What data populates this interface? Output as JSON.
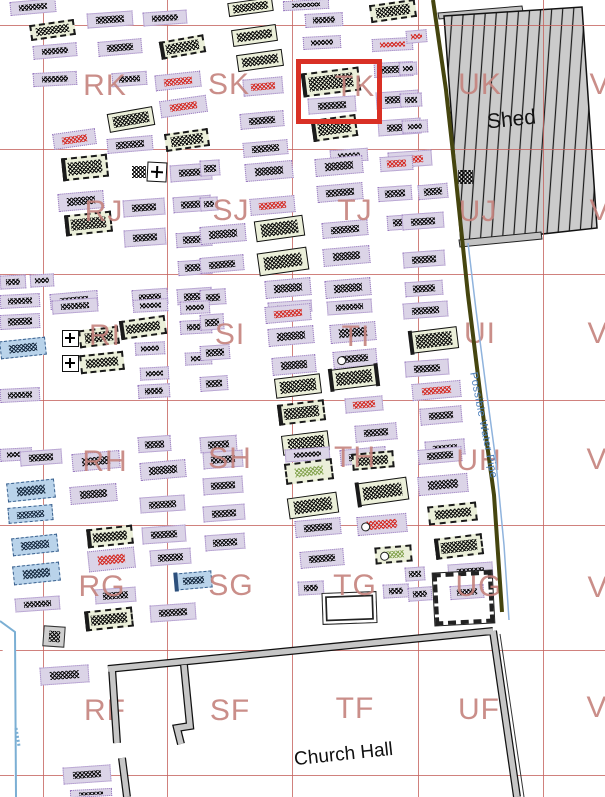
{
  "map": {
    "title": "Churchyard burial plot plan",
    "grid": {
      "line_color": "#c4625d",
      "verticals": [
        43,
        167,
        292,
        418,
        543
      ],
      "horizontals": [
        25,
        149,
        274,
        400,
        525,
        650,
        775
      ]
    },
    "sector_labels": [
      {
        "t": "RK",
        "x": 105,
        "y": 86
      },
      {
        "t": "SK",
        "x": 229,
        "y": 85
      },
      {
        "t": "TK",
        "x": 355,
        "y": 87
      },
      {
        "t": "UK",
        "x": 480,
        "y": 85
      },
      {
        "t": "V",
        "x": 600,
        "y": 85
      },
      {
        "t": "RJ",
        "x": 104,
        "y": 212
      },
      {
        "t": "SJ",
        "x": 231,
        "y": 211
      },
      {
        "t": "TJ",
        "x": 355,
        "y": 211
      },
      {
        "t": "UJ",
        "x": 478,
        "y": 212
      },
      {
        "t": "V",
        "x": 600,
        "y": 211
      },
      {
        "t": "RI",
        "x": 105,
        "y": 336
      },
      {
        "t": "SI",
        "x": 230,
        "y": 335
      },
      {
        "t": "TI",
        "x": 356,
        "y": 337
      },
      {
        "t": "UI",
        "x": 480,
        "y": 334
      },
      {
        "t": "V",
        "x": 598,
        "y": 334
      },
      {
        "t": "RH",
        "x": 105,
        "y": 462
      },
      {
        "t": "SH",
        "x": 230,
        "y": 459
      },
      {
        "t": "TH",
        "x": 355,
        "y": 458
      },
      {
        "t": "UH",
        "x": 479,
        "y": 461
      },
      {
        "t": "V",
        "x": 597,
        "y": 460
      },
      {
        "t": "RG",
        "x": 102,
        "y": 587
      },
      {
        "t": "SG",
        "x": 231,
        "y": 586
      },
      {
        "t": "TG",
        "x": 355,
        "y": 586
      },
      {
        "t": "UG",
        "x": 479,
        "y": 587
      },
      {
        "t": "V",
        "x": 598,
        "y": 588
      },
      {
        "t": "RF",
        "x": 105,
        "y": 711
      },
      {
        "t": "SF",
        "x": 230,
        "y": 711
      },
      {
        "t": "TF",
        "x": 355,
        "y": 709
      },
      {
        "t": "UF",
        "x": 479,
        "y": 710
      },
      {
        "t": "V",
        "x": 597,
        "y": 708
      }
    ],
    "texts": {
      "shed": "Shed",
      "church_hall": "Church Hall",
      "water_pipe": "Possible Water Pipe"
    },
    "highlight": {
      "x": 296,
      "y": 59,
      "w": 76,
      "h": 55,
      "color": "#d93025"
    },
    "colors": {
      "label": "#c5827d",
      "lavender_fill": "#dbd4e7",
      "lavender_border": "#9a7cc0",
      "green_fill": "#ebefd9",
      "blue_fill": "#b9d3ea",
      "hatch_black": "#0a0a0a",
      "hatch_red": "#d42a22",
      "hatch_green": "#86a552",
      "shed_fill": "#cbcbcb",
      "boundary_olive": "#45450f",
      "pipe_blue": "#8fb3dd",
      "wall_gray": "#c6c6c6",
      "highlight_red": "#d93025"
    },
    "grave_format": [
      "x",
      "y",
      "w",
      "h",
      "rotation_deg",
      "type",
      "circle_flag"
    ],
    "grave_types": {
      "lv": "lavender plot, black hatch",
      "lvr": "lavender plot, red hatch",
      "gd": "green plot, dashed border",
      "gdb": "green plot, dashed border, headstone bar",
      "gs": "green plot, solid border",
      "gsb": "green plot, solid border, headstone bar",
      "gsb2": "green plot, bars both ends",
      "gg": "green plot, green hatch",
      "bl": "blue plot",
      "blb": "blue plot, headstone bar",
      "ph": "plain hatch patch",
      "cross": "cross marker",
      "graysq": "gray square monument",
      "kerb": "kerbed plot, hatched border",
      "openrect": "open double-line plot"
    },
    "graves": [
      [
        10,
        0,
        46,
        14,
        -5,
        "lv"
      ],
      [
        87,
        12,
        46,
        15,
        -4,
        "lv"
      ],
      [
        143,
        11,
        44,
        14,
        -4,
        "lv"
      ],
      [
        228,
        0,
        45,
        14,
        -8,
        "gs"
      ],
      [
        283,
        0,
        46,
        10,
        -3,
        "lv"
      ],
      [
        370,
        2,
        46,
        18,
        -8,
        "gd"
      ],
      [
        30,
        22,
        45,
        16,
        -8,
        "gd"
      ],
      [
        305,
        13,
        38,
        14,
        -3,
        "lv"
      ],
      [
        33,
        44,
        44,
        14,
        -5,
        "lv"
      ],
      [
        98,
        40,
        44,
        15,
        -5,
        "lv"
      ],
      [
        160,
        38,
        45,
        18,
        -10,
        "gdb"
      ],
      [
        232,
        27,
        45,
        17,
        -8,
        "gs"
      ],
      [
        303,
        36,
        38,
        13,
        -3,
        "lv"
      ],
      [
        372,
        38,
        41,
        13,
        -3,
        "lvr"
      ],
      [
        406,
        30,
        21,
        13,
        -5,
        "lvr"
      ],
      [
        33,
        72,
        44,
        14,
        -3,
        "lv"
      ],
      [
        112,
        72,
        35,
        14,
        -4,
        "lv"
      ],
      [
        155,
        73,
        46,
        16,
        -6,
        "lvr"
      ],
      [
        237,
        52,
        46,
        17,
        -8,
        "gs"
      ],
      [
        243,
        78,
        40,
        17,
        -5,
        "lvr"
      ],
      [
        302,
        70,
        58,
        24,
        -7,
        "gdb"
      ],
      [
        374,
        62,
        39,
        15,
        -3,
        "lv"
      ],
      [
        399,
        62,
        18,
        13,
        -3,
        "lv"
      ],
      [
        308,
        97,
        48,
        16,
        -4,
        "lv"
      ],
      [
        160,
        98,
        47,
        17,
        -8,
        "lvr"
      ],
      [
        108,
        110,
        46,
        19,
        -10,
        "gs"
      ],
      [
        376,
        91,
        43,
        17,
        -4,
        "lv"
      ],
      [
        400,
        93,
        22,
        14,
        -3,
        "lv"
      ],
      [
        53,
        131,
        43,
        16,
        -8,
        "lvr"
      ],
      [
        107,
        137,
        46,
        15,
        -5,
        "lv"
      ],
      [
        165,
        131,
        44,
        18,
        -8,
        "gd"
      ],
      [
        312,
        117,
        45,
        22,
        -8,
        "gdb"
      ],
      [
        240,
        112,
        44,
        16,
        -5,
        "lv"
      ],
      [
        378,
        119,
        43,
        16,
        -4,
        "lv"
      ],
      [
        402,
        120,
        26,
        13,
        -3,
        "lv"
      ],
      [
        243,
        141,
        45,
        15,
        -5,
        "lv"
      ],
      [
        330,
        149,
        38,
        13,
        -4,
        "lv"
      ],
      [
        388,
        151,
        44,
        16,
        -4,
        "lvr"
      ],
      [
        62,
        156,
        46,
        23,
        -6,
        "gdb"
      ],
      [
        147,
        162,
        20,
        20,
        3,
        "cross"
      ],
      [
        132,
        166,
        14,
        12,
        0,
        "ph"
      ],
      [
        170,
        164,
        42,
        17,
        -4,
        "lv"
      ],
      [
        458,
        170,
        15,
        14,
        0,
        "ph"
      ],
      [
        200,
        160,
        20,
        16,
        -4,
        "lv"
      ],
      [
        245,
        162,
        48,
        18,
        -5,
        "lv"
      ],
      [
        315,
        157,
        48,
        18,
        -5,
        "lv"
      ],
      [
        380,
        156,
        33,
        15,
        -4,
        "lvr"
      ],
      [
        418,
        184,
        30,
        15,
        -5,
        "lv"
      ],
      [
        58,
        192,
        46,
        18,
        -5,
        "lv"
      ],
      [
        123,
        199,
        42,
        17,
        -4,
        "lv"
      ],
      [
        173,
        196,
        38,
        16,
        -4,
        "lv"
      ],
      [
        200,
        197,
        18,
        14,
        -4,
        "lv"
      ],
      [
        250,
        197,
        45,
        17,
        -5,
        "lvr"
      ],
      [
        317,
        184,
        46,
        17,
        -5,
        "lv"
      ],
      [
        378,
        186,
        34,
        15,
        -4,
        "lv"
      ],
      [
        65,
        213,
        47,
        21,
        -6,
        "gdb"
      ],
      [
        124,
        229,
        42,
        17,
        -4,
        "lv"
      ],
      [
        176,
        232,
        36,
        15,
        -4,
        "lv"
      ],
      [
        200,
        225,
        46,
        18,
        -5,
        "lv"
      ],
      [
        255,
        218,
        49,
        21,
        -8,
        "gs"
      ],
      [
        322,
        221,
        46,
        16,
        -5,
        "lv"
      ],
      [
        387,
        215,
        26,
        15,
        -4,
        "lv"
      ],
      [
        402,
        213,
        42,
        16,
        -4,
        "lv"
      ],
      [
        258,
        250,
        50,
        23,
        -8,
        "gs"
      ],
      [
        178,
        260,
        34,
        15,
        -4,
        "lv"
      ],
      [
        200,
        256,
        44,
        16,
        -5,
        "lv"
      ],
      [
        323,
        247,
        47,
        18,
        -5,
        "lv"
      ],
      [
        403,
        251,
        42,
        16,
        -4,
        "lv"
      ],
      [
        0,
        275,
        26,
        14,
        -3,
        "lv"
      ],
      [
        30,
        274,
        24,
        13,
        -3,
        "lv"
      ],
      [
        0,
        294,
        40,
        14,
        -3,
        "lv"
      ],
      [
        50,
        292,
        48,
        16,
        -5,
        "lv"
      ],
      [
        132,
        289,
        36,
        16,
        -4,
        "lv"
      ],
      [
        177,
        288,
        35,
        16,
        -4,
        "lv"
      ],
      [
        265,
        279,
        46,
        18,
        -5,
        "lv"
      ],
      [
        325,
        279,
        46,
        18,
        -5,
        "lv"
      ],
      [
        405,
        281,
        38,
        15,
        -4,
        "lv"
      ],
      [
        200,
        289,
        26,
        16,
        -4,
        "lv"
      ],
      [
        268,
        301,
        44,
        12,
        -4,
        "lv"
      ],
      [
        327,
        300,
        45,
        14,
        -4,
        "lv"
      ],
      [
        52,
        299,
        46,
        14,
        -4,
        "lv"
      ],
      [
        133,
        299,
        35,
        13,
        -3,
        "lv"
      ],
      [
        180,
        301,
        30,
        13,
        -3,
        "lv"
      ],
      [
        0,
        314,
        40,
        15,
        -3,
        "lv"
      ],
      [
        0,
        339,
        46,
        18,
        -6,
        "bl"
      ],
      [
        62,
        330,
        17,
        17,
        0,
        "cross"
      ],
      [
        79,
        328,
        40,
        18,
        -7,
        "gd"
      ],
      [
        120,
        318,
        46,
        19,
        -8,
        "gdb"
      ],
      [
        62,
        355,
        17,
        17,
        0,
        "cross"
      ],
      [
        80,
        353,
        44,
        19,
        -6,
        "gd"
      ],
      [
        135,
        342,
        30,
        13,
        -3,
        "lv"
      ],
      [
        180,
        320,
        32,
        14,
        -3,
        "lv"
      ],
      [
        185,
        352,
        27,
        13,
        -3,
        "lv"
      ],
      [
        140,
        367,
        29,
        13,
        -3,
        "lv"
      ],
      [
        265,
        305,
        46,
        17,
        -5,
        "lvr"
      ],
      [
        268,
        327,
        46,
        18,
        -5,
        "lv"
      ],
      [
        330,
        323,
        46,
        19,
        -5,
        "lv"
      ],
      [
        200,
        314,
        24,
        16,
        -4,
        "lv"
      ],
      [
        200,
        345,
        30,
        15,
        -4,
        "lv"
      ],
      [
        272,
        356,
        44,
        18,
        -5,
        "lv"
      ],
      [
        333,
        350,
        44,
        17,
        -5,
        "lv",
        1
      ],
      [
        403,
        302,
        45,
        16,
        -4,
        "lv"
      ],
      [
        410,
        329,
        48,
        22,
        -7,
        "gsb"
      ],
      [
        405,
        360,
        44,
        16,
        -4,
        "lv"
      ],
      [
        0,
        388,
        40,
        14,
        -3,
        "lv"
      ],
      [
        200,
        376,
        28,
        15,
        -4,
        "lv"
      ],
      [
        275,
        376,
        46,
        20,
        -7,
        "gs"
      ],
      [
        330,
        367,
        48,
        21,
        -7,
        "gsb2"
      ],
      [
        412,
        382,
        49,
        17,
        -5,
        "lvr"
      ],
      [
        345,
        397,
        38,
        15,
        -5,
        "lvr"
      ],
      [
        278,
        402,
        47,
        21,
        -7,
        "gdb"
      ],
      [
        138,
        384,
        32,
        14,
        -3,
        "lv"
      ],
      [
        355,
        424,
        42,
        17,
        -5,
        "lv"
      ],
      [
        420,
        407,
        42,
        17,
        -5,
        "lv"
      ],
      [
        138,
        436,
        33,
        16,
        -4,
        "lv"
      ],
      [
        200,
        436,
        37,
        16,
        -4,
        "lv"
      ],
      [
        282,
        433,
        47,
        20,
        -7,
        "gs"
      ],
      [
        0,
        448,
        32,
        13,
        -3,
        "lv"
      ],
      [
        425,
        440,
        40,
        16,
        -5,
        "lv"
      ],
      [
        20,
        450,
        42,
        15,
        -4,
        "lv"
      ],
      [
        72,
        452,
        48,
        18,
        -5,
        "lv"
      ],
      [
        140,
        461,
        46,
        18,
        -5,
        "lv"
      ],
      [
        203,
        451,
        40,
        17,
        -4,
        "lv"
      ],
      [
        285,
        448,
        45,
        13,
        -4,
        "lv"
      ],
      [
        340,
        448,
        46,
        16,
        -5,
        "lv"
      ],
      [
        352,
        452,
        42,
        17,
        -5,
        "gd"
      ],
      [
        418,
        448,
        44,
        15,
        -5,
        "lv"
      ],
      [
        285,
        461,
        48,
        21,
        -7,
        "gg"
      ],
      [
        7,
        481,
        48,
        19,
        -6,
        "bl"
      ],
      [
        70,
        485,
        47,
        18,
        -5,
        "lv"
      ],
      [
        203,
        477,
        40,
        17,
        -4,
        "lv"
      ],
      [
        418,
        475,
        50,
        19,
        -5,
        "lv"
      ],
      [
        8,
        506,
        45,
        16,
        -5,
        "bl"
      ],
      [
        140,
        496,
        45,
        16,
        -4,
        "lv"
      ],
      [
        288,
        495,
        50,
        21,
        -8,
        "gs"
      ],
      [
        357,
        480,
        51,
        23,
        -8,
        "gsb"
      ],
      [
        203,
        505,
        42,
        16,
        -4,
        "lv"
      ],
      [
        295,
        519,
        46,
        17,
        -5,
        "lv"
      ],
      [
        357,
        515,
        50,
        19,
        -5,
        "lvr",
        1
      ],
      [
        428,
        504,
        49,
        19,
        -6,
        "gd"
      ],
      [
        12,
        536,
        46,
        18,
        -6,
        "bl"
      ],
      [
        87,
        527,
        46,
        19,
        -6,
        "gdb"
      ],
      [
        142,
        526,
        44,
        17,
        -4,
        "lv"
      ],
      [
        205,
        534,
        40,
        16,
        -4,
        "lv"
      ],
      [
        88,
        549,
        47,
        21,
        -6,
        "lvr"
      ],
      [
        150,
        549,
        41,
        16,
        -4,
        "lv"
      ],
      [
        300,
        550,
        44,
        17,
        -5,
        "lv"
      ],
      [
        375,
        546,
        37,
        17,
        -5,
        "gg",
        1
      ],
      [
        435,
        536,
        48,
        21,
        -7,
        "gdb"
      ],
      [
        13,
        564,
        47,
        19,
        -6,
        "bl"
      ],
      [
        175,
        572,
        37,
        17,
        -5,
        "blb"
      ],
      [
        405,
        567,
        20,
        14,
        -4,
        "lv"
      ],
      [
        95,
        588,
        41,
        15,
        -4,
        "lv"
      ],
      [
        298,
        581,
        26,
        14,
        -3,
        "lv"
      ],
      [
        383,
        584,
        26,
        14,
        -3,
        "lv"
      ],
      [
        448,
        563,
        45,
        17,
        -4,
        "lv"
      ],
      [
        434,
        572,
        59,
        52,
        -3,
        "kerb"
      ],
      [
        450,
        585,
        34,
        14,
        -4,
        "lv"
      ],
      [
        322,
        592,
        55,
        32,
        -2,
        "openrect"
      ],
      [
        15,
        597,
        45,
        14,
        -4,
        "lv"
      ],
      [
        150,
        604,
        46,
        17,
        -4,
        "lv"
      ],
      [
        85,
        609,
        48,
        20,
        -6,
        "gdb"
      ],
      [
        408,
        587,
        24,
        14,
        -4,
        "lv"
      ],
      [
        43,
        626,
        22,
        21,
        4,
        "graysq"
      ],
      [
        40,
        666,
        49,
        18,
        -4,
        "lv"
      ],
      [
        63,
        766,
        48,
        17,
        -4,
        "lv"
      ],
      [
        70,
        789,
        42,
        8,
        -3,
        "lv"
      ]
    ]
  }
}
